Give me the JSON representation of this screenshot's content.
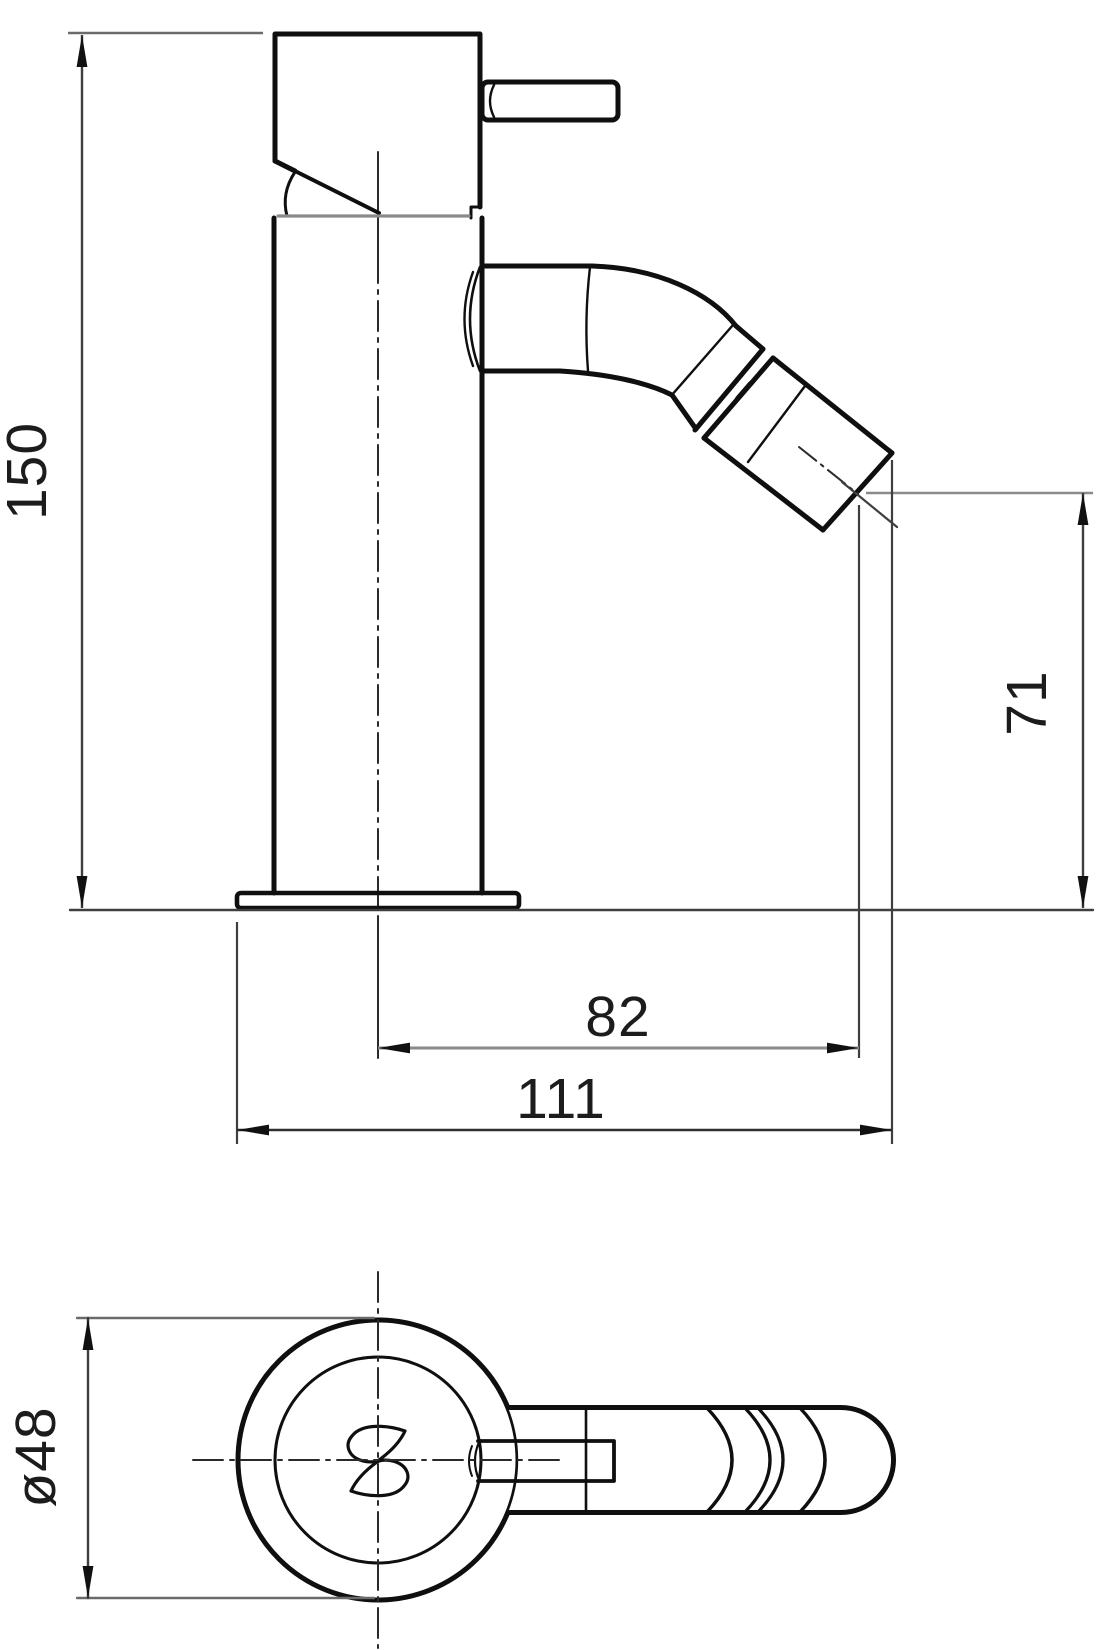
{
  "document": {
    "type": "technical-dimension-drawing",
    "subject": "single-lever bidet mixer tap, side elevation and plan view"
  },
  "dimensions": {
    "overall_height": "150",
    "spout_projection": "82",
    "total_projection": "111",
    "outlet_height": "71",
    "body_diameter": "ø48"
  },
  "colors": {
    "background": "#ffffff",
    "outline": "#0f0f0f",
    "dimension_line": "#3f3f3f",
    "seam_line": "#8a8a8a",
    "text": "#1c1c1c"
  }
}
